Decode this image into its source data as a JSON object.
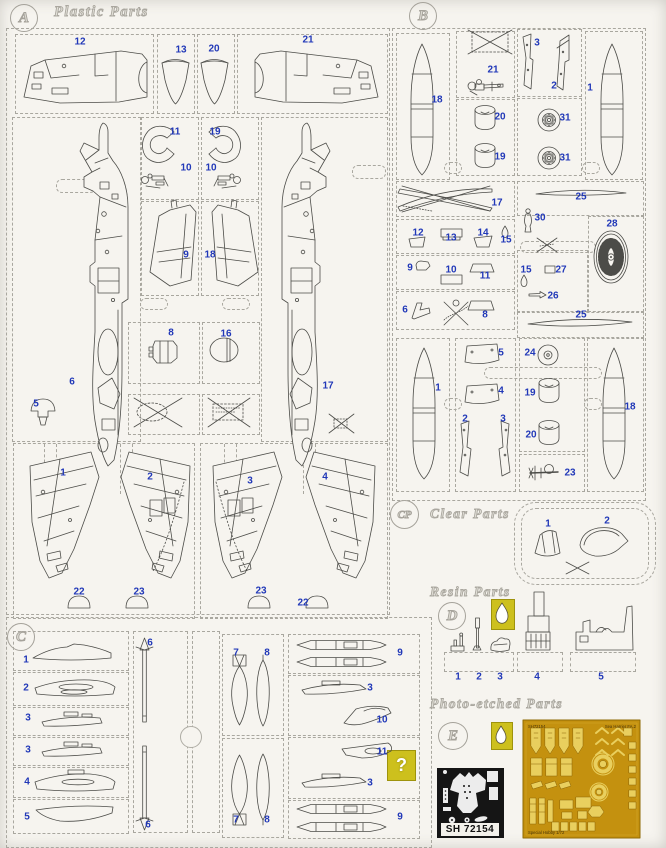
{
  "page": {
    "bg": "#f6f4ef",
    "accent_blue": "#2138b8",
    "dash_gray": "#a9a79f",
    "yellow": "#cdc01d",
    "fret_gold": "#c4910f",
    "fret_part_gold": "#e9cf5e",
    "film_black": "#151515"
  },
  "sections": {
    "a": {
      "badge": "A",
      "title": "Plastic Parts"
    },
    "b": {
      "badge": "B"
    },
    "c": {
      "badge": "C"
    },
    "cp": {
      "badge": "CP",
      "title": "Clear Parts"
    },
    "d": {
      "badge": "D",
      "title": "Resin Parts"
    },
    "e": {
      "badge": "E",
      "title": "Photo-etched Parts"
    }
  },
  "film": {
    "label": "SH 72154"
  },
  "fret": {
    "top_left": "SH72154",
    "top_right": "Sea Harrier FA.2",
    "bottom_left": "Special Hobby 1/72"
  },
  "misc": {
    "unknown_symbol": "?"
  },
  "part_labels": [
    {
      "s": "a",
      "t": "12",
      "x": 80,
      "y": 42
    },
    {
      "s": "a",
      "t": "13",
      "x": 181,
      "y": 50
    },
    {
      "s": "a",
      "t": "20",
      "x": 214,
      "y": 49
    },
    {
      "s": "a",
      "t": "21",
      "x": 308,
      "y": 40
    },
    {
      "s": "a",
      "t": "11",
      "x": 175,
      "y": 132
    },
    {
      "s": "a",
      "t": "19",
      "x": 215,
      "y": 132
    },
    {
      "s": "a",
      "t": "10",
      "x": 186,
      "y": 168
    },
    {
      "s": "a",
      "t": "10",
      "x": 211,
      "y": 168
    },
    {
      "s": "a",
      "t": "9",
      "x": 186,
      "y": 255
    },
    {
      "s": "a",
      "t": "18",
      "x": 210,
      "y": 255
    },
    {
      "s": "a",
      "t": "8",
      "x": 171,
      "y": 333
    },
    {
      "s": "a",
      "t": "16",
      "x": 226,
      "y": 334
    },
    {
      "s": "a",
      "t": "6",
      "x": 72,
      "y": 382
    },
    {
      "s": "a",
      "t": "17",
      "x": 328,
      "y": 386
    },
    {
      "s": "a",
      "t": "5",
      "x": 36,
      "y": 404
    },
    {
      "s": "a",
      "t": "1",
      "x": 63,
      "y": 473
    },
    {
      "s": "a",
      "t": "2",
      "x": 150,
      "y": 477
    },
    {
      "s": "a",
      "t": "3",
      "x": 250,
      "y": 481
    },
    {
      "s": "a",
      "t": "4",
      "x": 325,
      "y": 477
    },
    {
      "s": "a",
      "t": "22",
      "x": 79,
      "y": 592
    },
    {
      "s": "a",
      "t": "23",
      "x": 139,
      "y": 592
    },
    {
      "s": "a",
      "t": "23",
      "x": 261,
      "y": 591
    },
    {
      "s": "a",
      "t": "22",
      "x": 303,
      "y": 603
    },
    {
      "s": "b",
      "t": "18",
      "x": 437,
      "y": 100
    },
    {
      "s": "b",
      "t": "21",
      "x": 493,
      "y": 70
    },
    {
      "s": "b",
      "t": "3",
      "x": 537,
      "y": 43
    },
    {
      "s": "b",
      "t": "2",
      "x": 554,
      "y": 86
    },
    {
      "s": "b",
      "t": "1",
      "x": 590,
      "y": 88
    },
    {
      "s": "b",
      "t": "20",
      "x": 500,
      "y": 117
    },
    {
      "s": "b",
      "t": "19",
      "x": 500,
      "y": 157
    },
    {
      "s": "b",
      "t": "31",
      "x": 565,
      "y": 118
    },
    {
      "s": "b",
      "t": "31",
      "x": 565,
      "y": 158
    },
    {
      "s": "b",
      "t": "17",
      "x": 497,
      "y": 203
    },
    {
      "s": "b",
      "t": "25",
      "x": 581,
      "y": 197
    },
    {
      "s": "b",
      "t": "30",
      "x": 540,
      "y": 218
    },
    {
      "s": "b",
      "t": "28",
      "x": 612,
      "y": 224
    },
    {
      "s": "b",
      "t": "12",
      "x": 418,
      "y": 233
    },
    {
      "s": "b",
      "t": "13",
      "x": 451,
      "y": 238
    },
    {
      "s": "b",
      "t": "14",
      "x": 483,
      "y": 233
    },
    {
      "s": "b",
      "t": "15",
      "x": 506,
      "y": 240
    },
    {
      "s": "b",
      "t": "9",
      "x": 410,
      "y": 268
    },
    {
      "s": "b",
      "t": "10",
      "x": 451,
      "y": 270
    },
    {
      "s": "b",
      "t": "11",
      "x": 485,
      "y": 276
    },
    {
      "s": "b",
      "t": "15",
      "x": 526,
      "y": 270
    },
    {
      "s": "b",
      "t": "27",
      "x": 561,
      "y": 270
    },
    {
      "s": "b",
      "t": "26",
      "x": 553,
      "y": 296
    },
    {
      "s": "b",
      "t": "6",
      "x": 405,
      "y": 310
    },
    {
      "s": "b",
      "t": "8",
      "x": 485,
      "y": 315
    },
    {
      "s": "b",
      "t": "25",
      "x": 581,
      "y": 315
    },
    {
      "s": "b",
      "t": "1",
      "x": 438,
      "y": 388
    },
    {
      "s": "b",
      "t": "5",
      "x": 501,
      "y": 353
    },
    {
      "s": "b",
      "t": "4",
      "x": 501,
      "y": 391
    },
    {
      "s": "b",
      "t": "2",
      "x": 465,
      "y": 419
    },
    {
      "s": "b",
      "t": "3",
      "x": 503,
      "y": 419
    },
    {
      "s": "b",
      "t": "24",
      "x": 530,
      "y": 353
    },
    {
      "s": "b",
      "t": "19",
      "x": 530,
      "y": 393
    },
    {
      "s": "b",
      "t": "20",
      "x": 531,
      "y": 435
    },
    {
      "s": "b",
      "t": "23",
      "x": 570,
      "y": 473
    },
    {
      "s": "b",
      "t": "18",
      "x": 630,
      "y": 407
    },
    {
      "s": "cp",
      "t": "1",
      "x": 548,
      "y": 524
    },
    {
      "s": "cp",
      "t": "2",
      "x": 607,
      "y": 521
    },
    {
      "s": "d",
      "t": "1",
      "x": 458,
      "y": 677
    },
    {
      "s": "d",
      "t": "2",
      "x": 479,
      "y": 677
    },
    {
      "s": "d",
      "t": "3",
      "x": 500,
      "y": 677
    },
    {
      "s": "d",
      "t": "4",
      "x": 537,
      "y": 677
    },
    {
      "s": "d",
      "t": "5",
      "x": 601,
      "y": 677
    },
    {
      "s": "c",
      "t": "1",
      "x": 26,
      "y": 660
    },
    {
      "s": "c",
      "t": "2",
      "x": 26,
      "y": 688
    },
    {
      "s": "c",
      "t": "3",
      "x": 28,
      "y": 718
    },
    {
      "s": "c",
      "t": "3",
      "x": 28,
      "y": 750
    },
    {
      "s": "c",
      "t": "4",
      "x": 27,
      "y": 782
    },
    {
      "s": "c",
      "t": "5",
      "x": 27,
      "y": 817
    },
    {
      "s": "c",
      "t": "6",
      "x": 150,
      "y": 643
    },
    {
      "s": "c",
      "t": "6",
      "x": 148,
      "y": 825
    },
    {
      "s": "c",
      "t": "7",
      "x": 236,
      "y": 653
    },
    {
      "s": "c",
      "t": "8",
      "x": 267,
      "y": 653
    },
    {
      "s": "c",
      "t": "7",
      "x": 236,
      "y": 820
    },
    {
      "s": "c",
      "t": "8",
      "x": 267,
      "y": 820
    },
    {
      "s": "c",
      "t": "9",
      "x": 400,
      "y": 653
    },
    {
      "s": "c",
      "t": "3",
      "x": 370,
      "y": 688
    },
    {
      "s": "c",
      "t": "10",
      "x": 382,
      "y": 720
    },
    {
      "s": "c",
      "t": "11",
      "x": 382,
      "y": 752
    },
    {
      "s": "c",
      "t": "3",
      "x": 370,
      "y": 783
    },
    {
      "s": "c",
      "t": "9",
      "x": 400,
      "y": 817
    }
  ]
}
